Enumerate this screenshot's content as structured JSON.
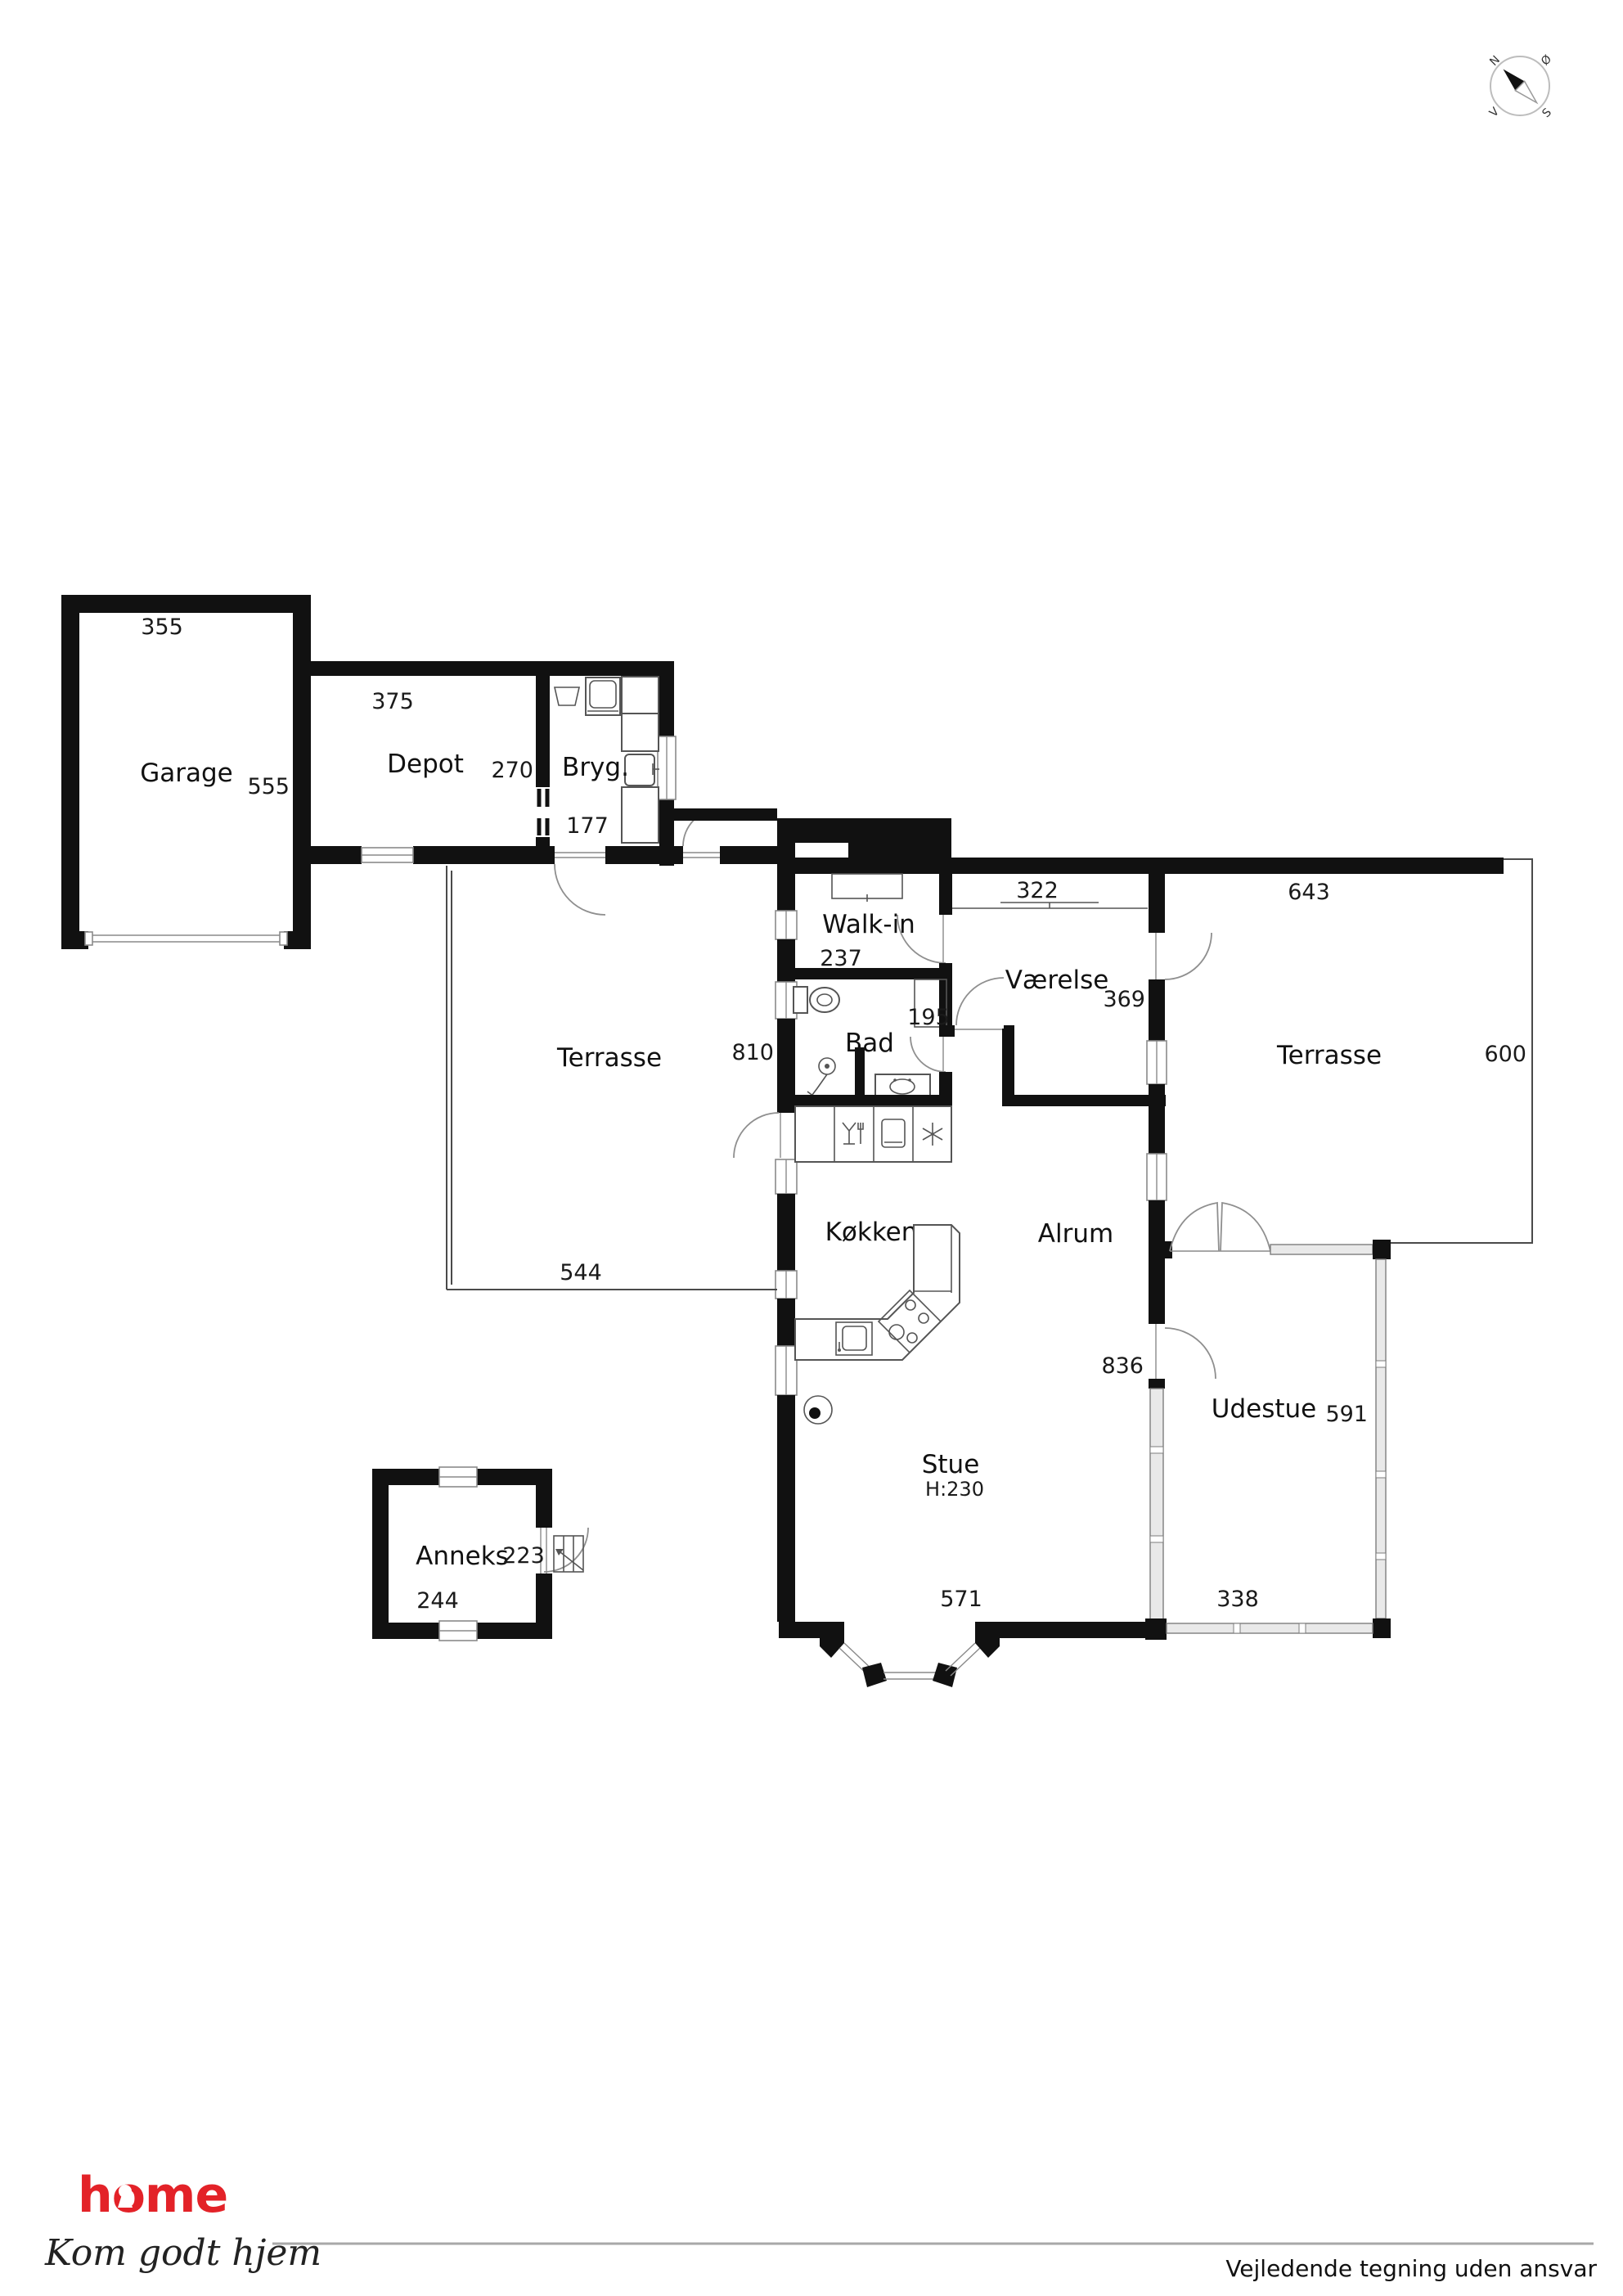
{
  "compass": {
    "north": "N",
    "east": "Ø",
    "south": "S",
    "west": "V"
  },
  "rooms": {
    "garage": {
      "label": "Garage",
      "dim_width": "355",
      "dim_depth": "555"
    },
    "depot": {
      "label": "Depot",
      "dim_width": "375",
      "dim_depth": "270"
    },
    "bryg": {
      "label": "Bryg.",
      "dim_width": "177"
    },
    "walkin": {
      "label": "Walk-in",
      "dim_width": "237"
    },
    "bad": {
      "label": "Bad",
      "dim_width": "195"
    },
    "vaerelse": {
      "label": "Værelse",
      "dim_width": "322",
      "dim_depth": "369"
    },
    "terrasse_vest": {
      "label": "Terrasse",
      "dim_width": "544",
      "dim_depth": "810"
    },
    "koekken": {
      "label": "Køkken"
    },
    "alrum": {
      "label": "Alrum",
      "dim_depth": "836"
    },
    "stue": {
      "label": "Stue",
      "ceiling_height": "H:230",
      "dim_width": "571"
    },
    "udestue": {
      "label": "Udestue",
      "dim_depth": "591",
      "dim_width": "338"
    },
    "terrasse_oest": {
      "label": "Terrasse",
      "dim_width": "643",
      "dim_depth": "600"
    },
    "anneks": {
      "label": "Anneks",
      "dim_depth": "223",
      "dim_width": "244"
    }
  },
  "footer": {
    "brand": "home",
    "tagline": "Kom godt hjem",
    "disclaimer": "Vejledende tegning uden ansvar"
  },
  "colors": {
    "brand_red": "#e32228",
    "wall": "#111111"
  },
  "icons": {
    "compass-icon": "circle-with-needle",
    "washing-machine-icon": "square-drum",
    "laundry-sink-icon": "trapezoid-basin",
    "toilet-icon": "tank-and-bowl",
    "shower-icon": "shower-head",
    "bath-sink-icon": "oval-basin",
    "kitchen-sink-icon": "rounded-basin",
    "stove-icon": "diamond-4-burners",
    "dishwasher-icon": "glass-and-fork",
    "oven-icon": "rounded-square",
    "freezer-icon": "snowflake",
    "wood-stove-icon": "circle-dot",
    "wardrobe-icon": "rect-shelf",
    "stairs-icon": "steps-with-arrow",
    "keyhole-icon": "keyhole"
  }
}
